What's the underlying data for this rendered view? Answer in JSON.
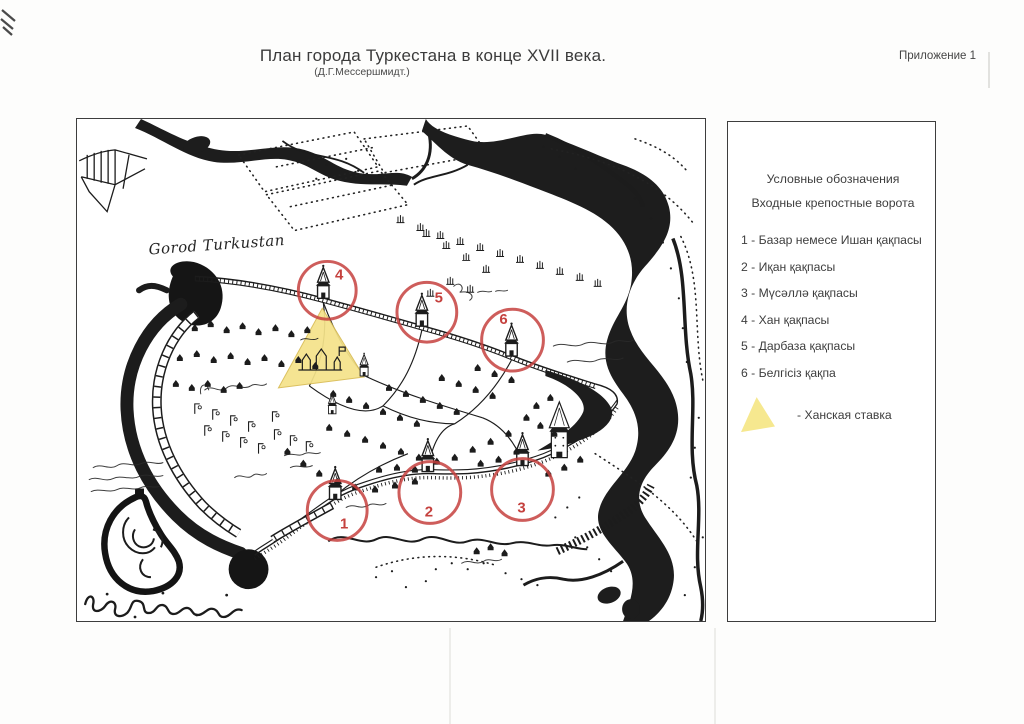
{
  "page": {
    "title": "План города Туркестана в конце XVII века.",
    "subtitle": "(Д.Г.Мессершмидт.)",
    "annex": "Приложение 1"
  },
  "map": {
    "handwritten_label": "Gorod Turkustan",
    "gate_markers": [
      {
        "label": "1",
        "cx": 261,
        "cy": 393,
        "r": 30,
        "tx": 268,
        "ty": 411
      },
      {
        "label": "2",
        "cx": 354,
        "cy": 375,
        "r": 31,
        "tx": 353,
        "ty": 399
      },
      {
        "label": "3",
        "cx": 447,
        "cy": 372,
        "r": 31,
        "tx": 446,
        "ty": 395
      },
      {
        "label": "4",
        "cx": 251,
        "cy": 172,
        "r": 29,
        "tx": 263,
        "ty": 161
      },
      {
        "label": "5",
        "cx": 351,
        "cy": 194,
        "r": 30,
        "tx": 363,
        "ty": 184
      },
      {
        "label": "6",
        "cx": 437,
        "cy": 222,
        "r": 31,
        "tx": 428,
        "ty": 206
      }
    ]
  },
  "legend": {
    "heading1": "Условные обозначения",
    "heading2": "Входные крепостные ворота",
    "items": [
      {
        "number": "1",
        "name": "Базар немесе Ишан қақпасы"
      },
      {
        "number": "2",
        "name": "Иқан қақпасы"
      },
      {
        "number": "3",
        "name": "Мүсәллә қақпасы"
      },
      {
        "number": "4",
        "name": "Хан қақпасы"
      },
      {
        "number": "5",
        "name": "Дарбаза қақпасы"
      },
      {
        "number": "6",
        "name": "Белгісіз қақпа"
      }
    ],
    "swatch_label": "- Ханская ставка"
  },
  "colors": {
    "accent_red": "#c5413e",
    "highlight_yellow": "#f5e38a",
    "ink": "#1c1c1c",
    "frame_gray": "#3d3d3d"
  }
}
